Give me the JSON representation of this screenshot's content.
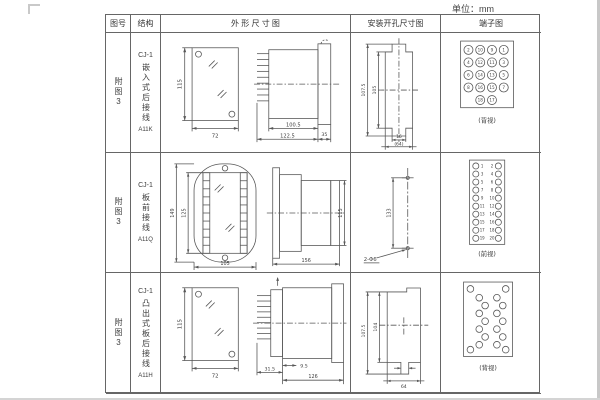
{
  "page": {
    "unit_label": "单位：mm"
  },
  "headers": {
    "fig_no": "图号",
    "structure": "结构",
    "outline": "外 形 尺 寸 图",
    "mounting": "安装开孔尺寸图",
    "terminal": "端子图"
  },
  "rows": [
    {
      "fig_no": "附图3",
      "model": "CJ-1",
      "structure": "嵌入式后接线",
      "code": "A11K",
      "outline_dims": {
        "front_height": "115",
        "front_width": "72",
        "body_depth": "100.5",
        "total_depth": "122.5",
        "flange_depth": "35"
      },
      "mounting_dims": {
        "outer_height": "107.5",
        "inner_height": "105",
        "tab_width": "16",
        "cutout_width": "(64)"
      },
      "terminal": {
        "caption": "(背视)",
        "grid": [
          [
            2,
            10,
            9,
            1
          ],
          [
            4,
            12,
            11,
            3
          ],
          [
            6,
            14,
            13,
            5
          ],
          [
            8,
            16,
            15,
            7
          ],
          [
            18,
            17
          ]
        ]
      }
    },
    {
      "fig_no": "附图3",
      "model": "CJ-1",
      "structure": "板前接线",
      "code": "A11Q",
      "outline_dims": {
        "outer_height": "149",
        "inner_height": "125",
        "front_width": "105",
        "depth": "156",
        "body_height": "115"
      },
      "mounting_dims": {
        "hole_spacing": "133",
        "hole_label": "2-Φ6"
      },
      "terminal": {
        "caption": "(前视)",
        "left_numbers": [
          1,
          3,
          5,
          7,
          9,
          11,
          13,
          15,
          17,
          19
        ],
        "right_numbers": [
          2,
          4,
          6,
          8,
          10,
          12,
          14,
          16,
          18,
          20
        ]
      }
    },
    {
      "fig_no": "附图3",
      "model": "CJ-1",
      "structure": "凸出式板后接线",
      "code": "A11H",
      "outline_dims": {
        "front_height": "115",
        "front_width": "72",
        "base_depth": "31.5",
        "offset": "9.5",
        "body_depth": "126"
      },
      "mounting_dims": {
        "outer_height": "107.5",
        "inner_height": "104",
        "cutout_width": "64"
      },
      "terminal": {
        "caption": "(背视)"
      }
    }
  ]
}
